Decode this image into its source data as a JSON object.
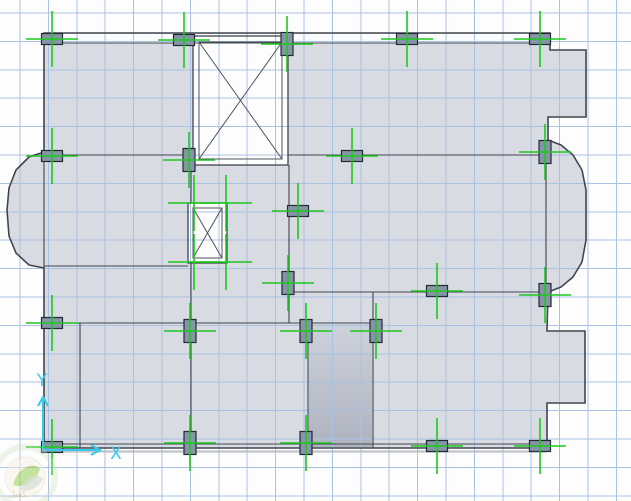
{
  "plan": {
    "canvas": {
      "w": 631,
      "h": 501,
      "background": "#fdfdfe"
    },
    "grid": {
      "spacing": 28.4,
      "offset_x": 20,
      "offset_y": 13,
      "color": "#aac2e2",
      "width": 1
    },
    "colors": {
      "slab": "#d8dbe2",
      "wall": "#41464f",
      "wall_thin": "#4d525b",
      "column_fill": "#8594a9",
      "column_border": "#262b33",
      "cross_green": "#1dc81d",
      "axis_cyan": "#36c9e9",
      "shaft_fill": "#fdfdfe",
      "top_band_fill": "#fafbfd",
      "shadow": "#b6bac2",
      "room_gradient_top": "#cdd1da",
      "room_gradient_bottom": "#aeb3c0"
    },
    "outline": [
      [
        44,
        33
      ],
      [
        550,
        33
      ],
      [
        550,
        50
      ],
      [
        586,
        50
      ],
      [
        586,
        117
      ],
      [
        548,
        117
      ],
      [
        548,
        140
      ],
      [
        561,
        145
      ],
      [
        573,
        155
      ],
      [
        582,
        170
      ],
      [
        586,
        190
      ],
      [
        586,
        240
      ],
      [
        582,
        262
      ],
      [
        573,
        277
      ],
      [
        561,
        287
      ],
      [
        548,
        292
      ],
      [
        547,
        331
      ],
      [
        585,
        331
      ],
      [
        585,
        403
      ],
      [
        547,
        403
      ],
      [
        547,
        448
      ],
      [
        44,
        448
      ],
      [
        44,
        268
      ],
      [
        29,
        265
      ],
      [
        16,
        253
      ],
      [
        9,
        236
      ],
      [
        7,
        210
      ],
      [
        9,
        188
      ],
      [
        16,
        170
      ],
      [
        29,
        157
      ],
      [
        44,
        152
      ]
    ],
    "top_band": [
      45,
      34,
      504,
      8.5
    ],
    "walls": [
      [
        44,
        43,
        550,
        43
      ],
      [
        44,
        155,
        193,
        155
      ],
      [
        288,
        155,
        546,
        155
      ],
      [
        546,
        147,
        546,
        291
      ],
      [
        44,
        152,
        44,
        268
      ],
      [
        44,
        266,
        188,
        266
      ],
      [
        191,
        165,
        191,
        203
      ],
      [
        191,
        263,
        191,
        448
      ],
      [
        289,
        165,
        289,
        323
      ],
      [
        289,
        292,
        546,
        292
      ],
      [
        373,
        292,
        373,
        448
      ],
      [
        44,
        323,
        376,
        323
      ],
      [
        80,
        323,
        80,
        448
      ],
      [
        308,
        323,
        308,
        448
      ],
      [
        44,
        444,
        547,
        444
      ]
    ],
    "shadow_lines": [
      [
        46,
        451.5,
        547,
        451.5
      ]
    ],
    "shafts": [
      {
        "name": "elevator-shaft",
        "outer": [
          193,
          36,
          95,
          129
        ],
        "inner": [
          199,
          42,
          83,
          117
        ]
      },
      {
        "name": "stair-shaft",
        "outer": [
          188,
          203,
          39,
          60
        ],
        "inner": [
          193,
          208,
          29,
          50
        ]
      }
    ],
    "dark_room": [
      309,
      324,
      63,
      123
    ],
    "columns": [
      {
        "x": 52,
        "y": 39,
        "o": "H"
      },
      {
        "x": 184,
        "y": 40,
        "o": "H"
      },
      {
        "x": 287,
        "y": 44,
        "o": "V"
      },
      {
        "x": 407,
        "y": 39,
        "o": "H"
      },
      {
        "x": 540,
        "y": 39,
        "o": "H"
      },
      {
        "x": 52,
        "y": 156,
        "o": "H"
      },
      {
        "x": 189,
        "y": 160,
        "o": "V"
      },
      {
        "x": 352,
        "y": 156,
        "o": "H"
      },
      {
        "x": 545,
        "y": 152,
        "o": "V"
      },
      {
        "x": 298,
        "y": 211,
        "o": "H"
      },
      {
        "x": 288,
        "y": 283,
        "o": "V"
      },
      {
        "x": 437,
        "y": 291,
        "o": "H"
      },
      {
        "x": 545,
        "y": 295,
        "o": "V"
      },
      {
        "x": 52,
        "y": 323,
        "o": "H"
      },
      {
        "x": 190,
        "y": 331,
        "o": "V"
      },
      {
        "x": 306,
        "y": 331,
        "o": "V"
      },
      {
        "x": 376,
        "y": 331,
        "o": "V"
      },
      {
        "x": 52,
        "y": 447,
        "o": "H"
      },
      {
        "x": 190,
        "y": 443,
        "o": "V"
      },
      {
        "x": 306,
        "y": 443,
        "o": "V"
      },
      {
        "x": 437,
        "y": 446,
        "o": "H"
      },
      {
        "x": 540,
        "y": 446,
        "o": "H"
      }
    ],
    "free_crosses": [
      [
        194,
        203
      ],
      [
        226,
        203
      ],
      [
        194,
        262
      ],
      [
        226,
        262
      ]
    ],
    "cross": {
      "half_h": 26,
      "half_v": 28,
      "width": 1.6
    },
    "column_size": {
      "H": [
        21,
        11
      ],
      "V": [
        12,
        23
      ]
    },
    "axis": {
      "origin": [
        43,
        450
      ],
      "x_end": [
        100,
        450
      ],
      "y_end": [
        43,
        397
      ],
      "x_label": "X",
      "y_label": "Y",
      "x_label_pos": [
        116,
        459
      ],
      "y_label_pos": [
        42,
        386
      ],
      "font_size": 17
    },
    "watermark": {
      "cx": 25,
      "cy": 477,
      "r_outer": 30,
      "r_inner": 20,
      "ring_color": "#cfe0bc",
      "disc_fill": "#f6f2e0",
      "leaf_green": "#8dc63f",
      "leaf_gray": "#b9c4bd",
      "text": "كفيل",
      "text_color": "#c9b784",
      "text_pos": [
        8,
        497
      ],
      "opacity": 0.55
    }
  }
}
